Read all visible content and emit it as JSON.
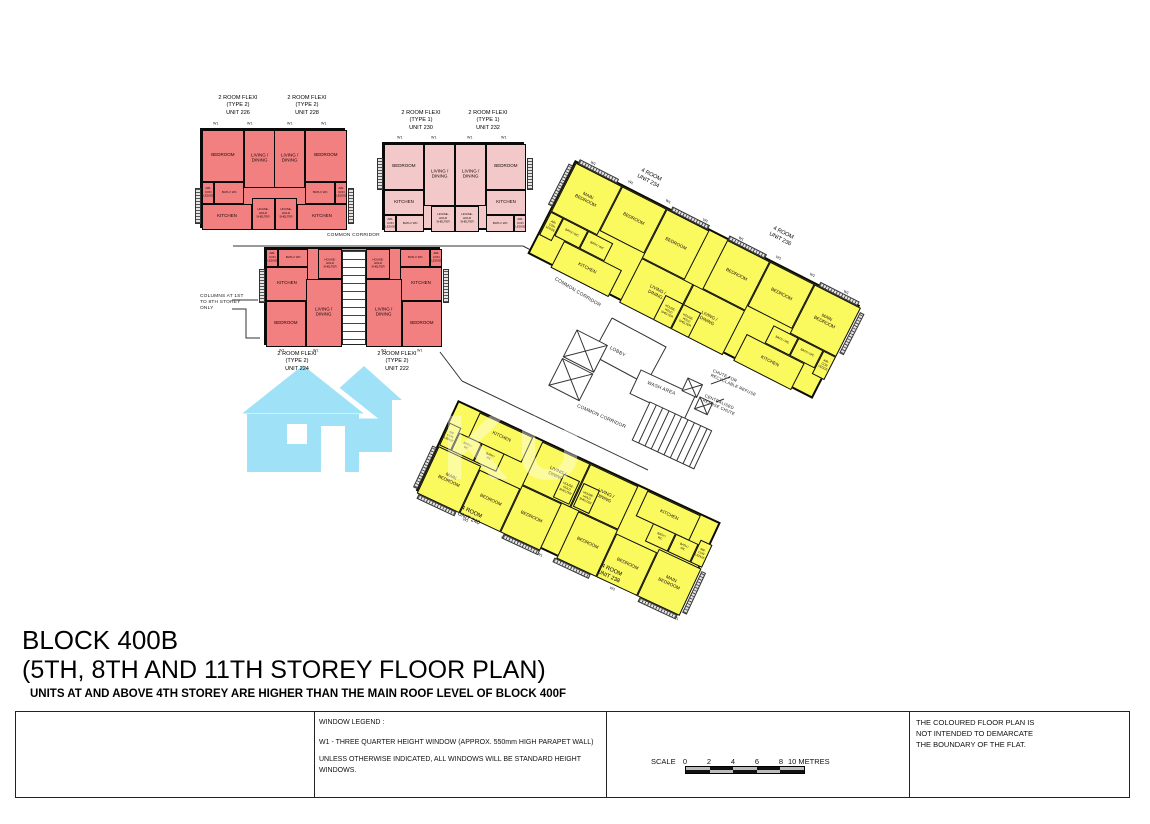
{
  "title": {
    "line1": "BLOCK 400B",
    "line2": "(5TH, 8TH AND 11TH STOREY FLOOR PLAN)",
    "note": "UNITS AT AND ABOVE 4TH STOREY ARE HIGHER THAN THE MAIN ROOF LEVEL OF BLOCK 400F"
  },
  "labels": {
    "bedroom": "BEDROOM",
    "main_bedroom": "MAIN\nBEDROOM",
    "living_dining": "LIVING /\nDINING",
    "kitchen": "KITCHEN",
    "bath_wc": "BATH / WC",
    "aircon": "AIR-CON\nLEDGE",
    "hh_shelter": "HOUSE-\nHOLD\nSHELTER",
    "common_corridor": "COMMON CORRIDOR",
    "lobby": "LOBBY",
    "wash_area": "WASH AREA",
    "chute_recyclable": "CHUTE FOR\nRECYCLABLE REFUSE",
    "refuse_chute": "CENTRALISED\nREFUSE CHUTE",
    "window_label": "W1",
    "columns_note": "COLUMNS AT 1ST\nTO 8TH STOREY\nONLY"
  },
  "units": {
    "u226": "2 ROOM FLEXI\n(TYPE 2)\nUNIT 226",
    "u228": "2 ROOM FLEXI\n(TYPE 2)\nUNIT 228",
    "u230": "2 ROOM FLEXI\n(TYPE 1)\nUNIT 230",
    "u232": "2 ROOM FLEXI\n(TYPE 1)\nUNIT 232",
    "u224": "2 ROOM FLEXI\n(TYPE 2)\nUNIT 224",
    "u222": "2 ROOM FLEXI\n(TYPE 2)\nUNIT 222",
    "u234": "4 ROOM\nUNIT 234",
    "u236": "4 ROOM\nUNIT 236",
    "u240": "4 ROOM\nUNIT 240",
    "u238": "4 ROOM\nUNIT 238"
  },
  "legend": {
    "window_legend_title": "WINDOW LEGEND :",
    "w1_line": "W1  - THREE QUARTER HEIGHT WINDOW (APPROX. 550mm HIGH PARAPET WALL)",
    "unless_line": "UNLESS OTHERWISE INDICATED, ALL WINDOWS WILL BE STANDARD HEIGHT WINDOWS.",
    "scale_label": "SCALE",
    "scale_ticks": [
      "0",
      "2",
      "4",
      "6",
      "8"
    ],
    "scale_unit": "10 METRES",
    "disclaimer": "THE COLOURED FLOOR PLAN IS\nNOT INTENDED TO DEMARCATE\nTHE BOUNDARY OF THE FLAT."
  },
  "watermark": {
    "letters": "KU"
  },
  "colors": {
    "type2_fill": "#F38080",
    "type1_fill": "#F3C8C8",
    "four_room_fill": "#FAFA5F",
    "watermark_blue": "#9FE2F8",
    "wall": "#0A0A0A"
  }
}
